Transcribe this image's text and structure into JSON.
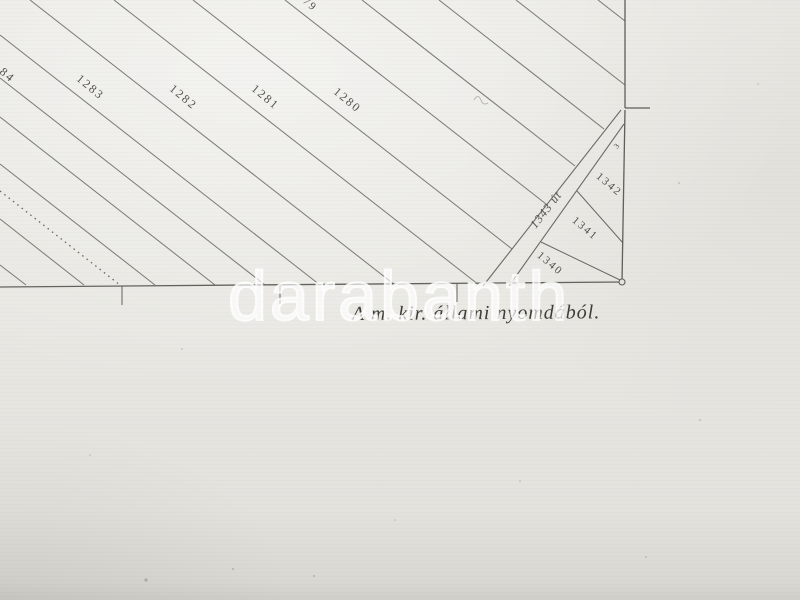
{
  "document": {
    "kind": "scanned cadastral map sheet (photograph)",
    "caption": "A m. kir. állami nyomdából."
  },
  "watermark": {
    "text": "darabanth"
  },
  "colors": {
    "paper": "#e8e7e2",
    "hatch_ink": "#7a7973",
    "border_ink": "#5f5e58",
    "label_ink": "#52514b",
    "caption_ink": "#3e3c36",
    "watermark_white": "#ffffff"
  },
  "map": {
    "parcel_labels": [
      {
        "text": "84",
        "x": 5,
        "y": 78,
        "rot": 40,
        "size": 12
      },
      {
        "text": "1283",
        "x": 88,
        "y": 90,
        "rot": 40,
        "size": 12
      },
      {
        "text": "1282",
        "x": 181,
        "y": 100,
        "rot": 40,
        "size": 12
      },
      {
        "text": "1281",
        "x": 263,
        "y": 100,
        "rot": 40,
        "size": 12
      },
      {
        "text": "1280",
        "x": 345,
        "y": 103,
        "rot": 40,
        "size": 12
      },
      {
        "text": "79",
        "x": 308,
        "y": 7,
        "rot": 40,
        "size": 11
      },
      {
        "text": "1342",
        "x": 607,
        "y": 187,
        "rot": 40,
        "size": 11
      },
      {
        "text": "1341",
        "x": 583,
        "y": 231,
        "rot": 40,
        "size": 11
      },
      {
        "text": "1340",
        "x": 548,
        "y": 266,
        "rot": 40,
        "size": 11
      },
      {
        "text": "3",
        "x": 619,
        "y": 147,
        "rot": -50,
        "size": 8
      }
    ],
    "road_label": {
      "text": "1343 út",
      "x": 549,
      "y": 212,
      "rot": -52,
      "size": 12,
      "italic": true
    }
  }
}
